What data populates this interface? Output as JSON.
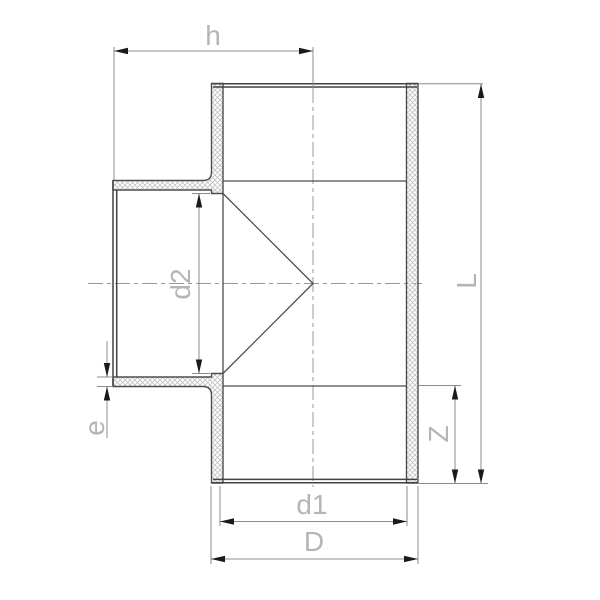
{
  "drawing": {
    "type": "technical-cross-section",
    "subject": "tee-pipe-fitting",
    "labels": {
      "h": "h",
      "d2": "d2",
      "e": "e",
      "Z": "Z",
      "L": "L",
      "d1": "d1",
      "D": "D"
    },
    "colors": {
      "background": "#ffffff",
      "body_line": "#4d4d4d",
      "edge_line": "#424242",
      "hatch_line": "#c4c4c4",
      "dimension_line": "#8c8c8c",
      "centerline": "#999999",
      "arrow": "#1a1a1a",
      "label_text": "#b5b5b5"
    }
  }
}
